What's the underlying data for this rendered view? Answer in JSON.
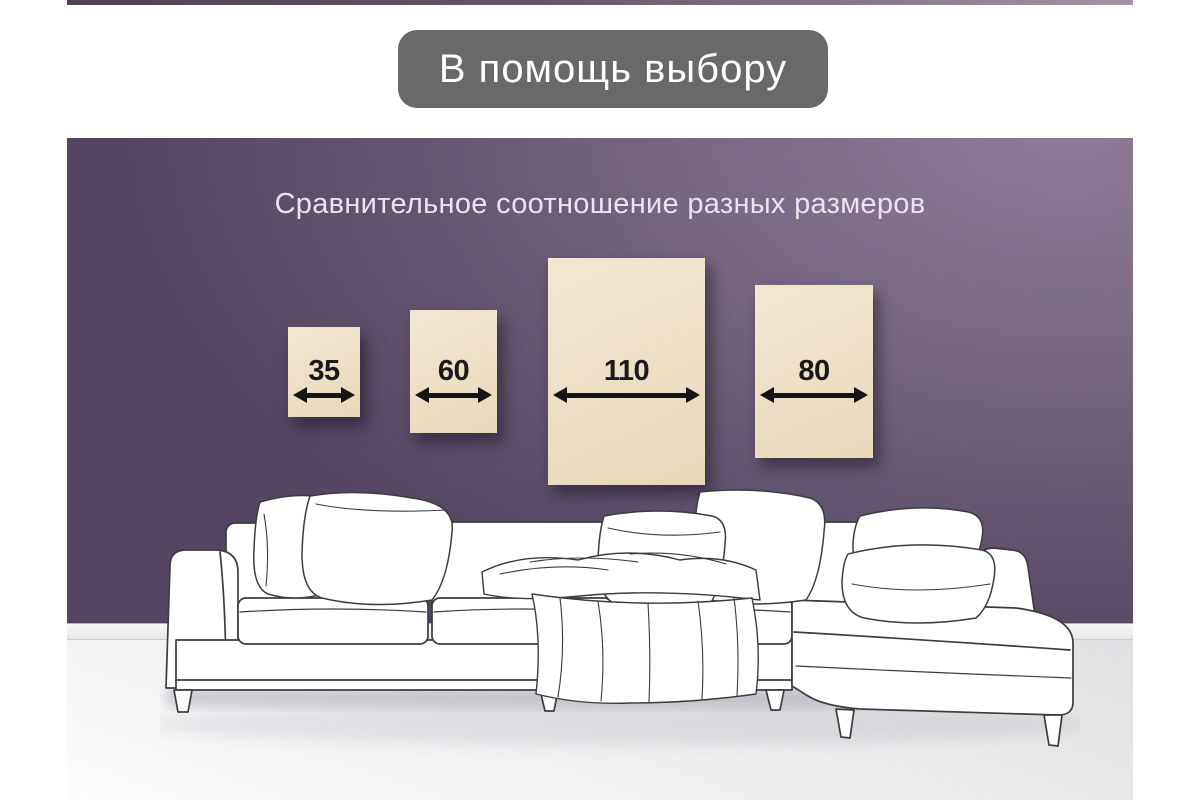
{
  "header": {
    "pill_label": "В помощь выбору",
    "pill_color": "#696969",
    "pill_text_color": "#ffffff"
  },
  "top_bar": {
    "color_left": "#4f4354",
    "color_right": "#a294ab"
  },
  "scene": {
    "subtitle": "Сравнительное соотношение разных размеров",
    "subtitle_color": "#eae4ee",
    "wall_color_dark": "#544661",
    "wall_color_light": "#907b98",
    "baseboard_color": "#f4f3f1",
    "floor_color": "#ebebed",
    "panel_color": "#ecdfc4",
    "dimension_color": "#141414",
    "illustration": "white-sketch-sectional-sofa"
  },
  "size_panels": [
    {
      "label": "35"
    },
    {
      "label": "60"
    },
    {
      "label": "110"
    },
    {
      "label": "80"
    }
  ]
}
